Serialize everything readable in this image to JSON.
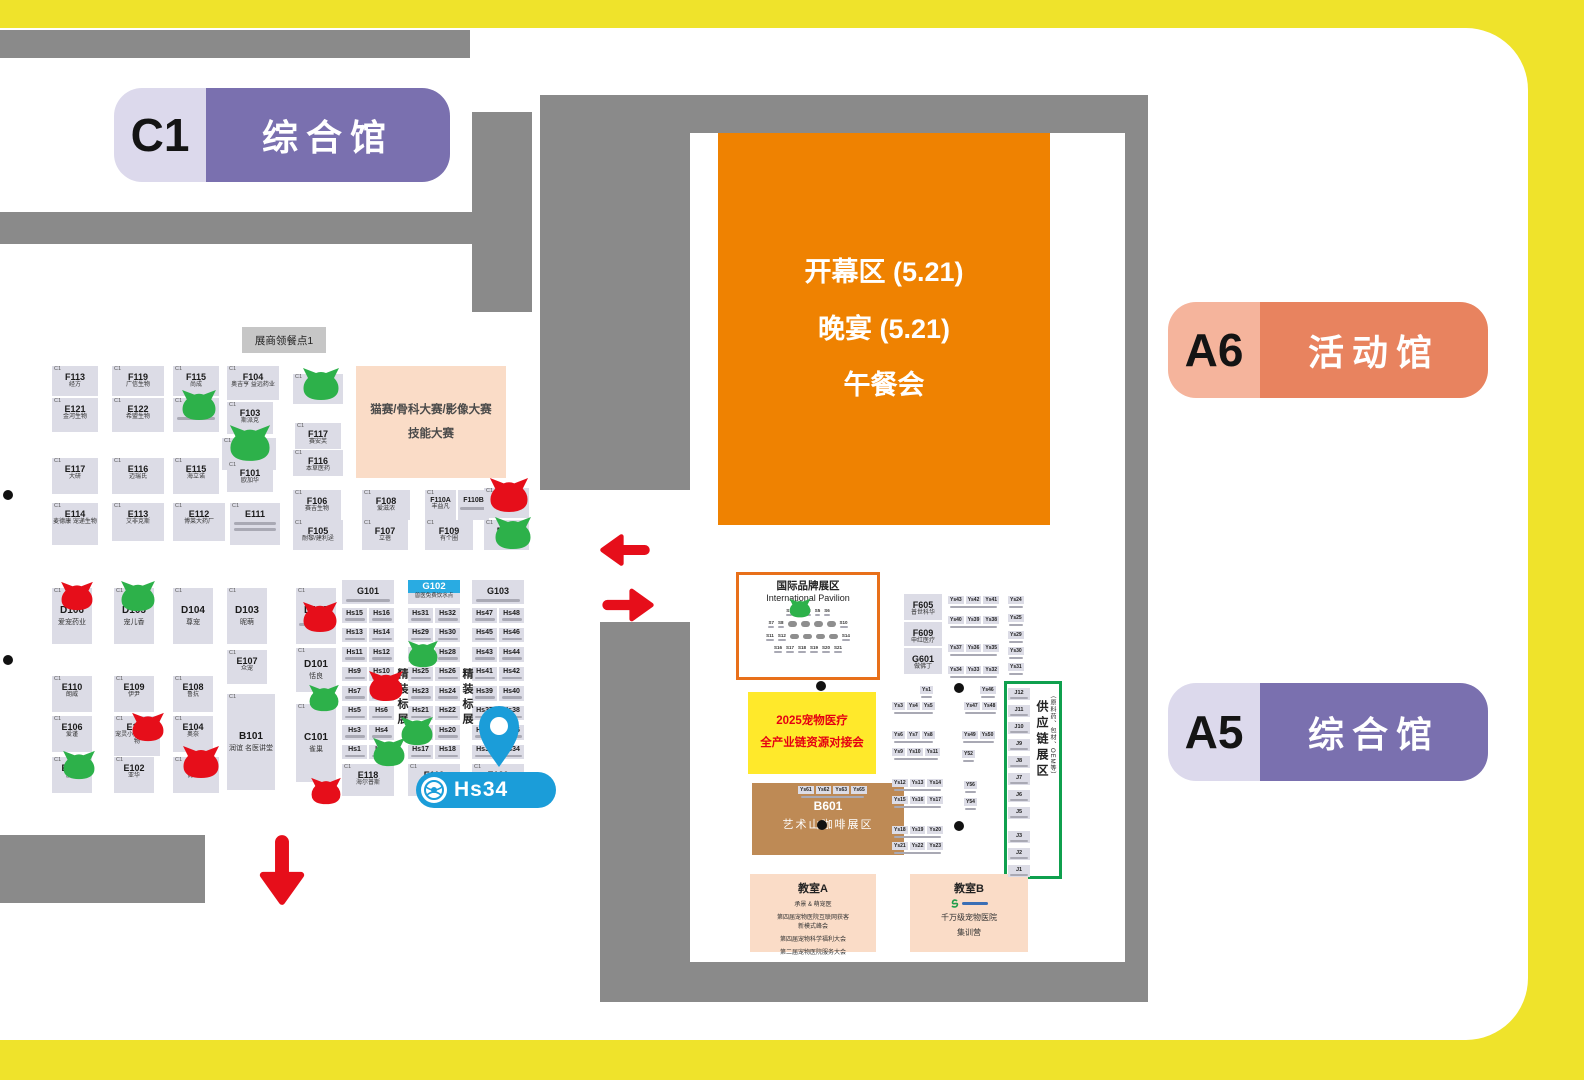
{
  "colors": {
    "frame_yellow": "#EFE32B",
    "wall_gray": "#8A8A8A",
    "booth_bg": "#DCDCE6",
    "purple": "#7A70AF",
    "purple_light": "#DCD9EC",
    "orange_deep": "#EF8201",
    "orange_pill": "#E8835F",
    "orange_pill_light": "#F5B49C",
    "pink_box": "#FADCC7",
    "yellow_box": "#FFE92B",
    "brown": "#BE8A55",
    "red": "#E60E1A",
    "green": "#2DB14A",
    "blue": "#29ABE2",
    "pin_blue": "#1B9DD9",
    "supply_green": "#0FA04E",
    "pavilion_border": "#E8701A",
    "text_red": "#E50012"
  },
  "halls": {
    "c1": {
      "code": "C1",
      "label": "综合馆"
    },
    "a6": {
      "code": "A6",
      "label": "活动馆"
    },
    "a5": {
      "code": "A5",
      "label": "综合馆"
    }
  },
  "marker": {
    "label": "Hs34"
  },
  "left_map": {
    "meal_label": "展商领餐点1",
    "contest": {
      "l1": "猫赛/骨科大赛/影像大赛",
      "l2": "技能大赛"
    },
    "booths": [
      {
        "x": 52,
        "y": 366,
        "w": 46,
        "h": 30,
        "hall": "C1",
        "code": "F113",
        "name": "经方"
      },
      {
        "x": 112,
        "y": 366,
        "w": 52,
        "h": 30,
        "hall": "C1",
        "code": "F119",
        "name": "广信生物"
      },
      {
        "x": 173,
        "y": 366,
        "w": 46,
        "h": 30,
        "hall": "C1",
        "code": "F115",
        "name": "尚成"
      },
      {
        "x": 227,
        "y": 366,
        "w": 52,
        "h": 34,
        "hall": "C1",
        "code": "F104",
        "name": "奥吉亨 益远药业"
      },
      {
        "x": 293,
        "y": 374,
        "w": 50,
        "h": 30,
        "hall": "C1",
        "code": "F118",
        "name": "小可爱药"
      },
      {
        "x": 52,
        "y": 398,
        "w": 46,
        "h": 34,
        "hall": "C1",
        "code": "E121",
        "name": "金河生物"
      },
      {
        "x": 112,
        "y": 398,
        "w": 52,
        "h": 34,
        "hall": "C1",
        "code": "E122",
        "name": "希盟生物"
      },
      {
        "x": 173,
        "y": 398,
        "w": 46,
        "h": 34,
        "hall": "C1",
        "code": "E123",
        "sm": 1
      },
      {
        "x": 227,
        "y": 402,
        "w": 46,
        "h": 32,
        "hall": "C1",
        "code": "F103",
        "name": "斯派克"
      },
      {
        "x": 295,
        "y": 423,
        "w": 46,
        "h": 26,
        "hall": "C1",
        "code": "F117",
        "name": "赛安芙"
      },
      {
        "x": 293,
        "y": 450,
        "w": 50,
        "h": 26,
        "hall": "C1",
        "code": "F116",
        "name": "本草医药"
      },
      {
        "x": 222,
        "y": 438,
        "w": 54,
        "h": 32,
        "hall": "C1",
        "code": "F102",
        "name": "宜景康"
      },
      {
        "x": 52,
        "y": 458,
        "w": 46,
        "h": 36,
        "hall": "C1",
        "code": "E117",
        "name": "大研"
      },
      {
        "x": 112,
        "y": 458,
        "w": 52,
        "h": 36,
        "hall": "C1",
        "code": "E116",
        "name": "迈瑞氏"
      },
      {
        "x": 173,
        "y": 458,
        "w": 46,
        "h": 36,
        "hall": "C1",
        "code": "E115",
        "name": "海立诺"
      },
      {
        "x": 227,
        "y": 462,
        "w": 46,
        "h": 30,
        "hall": "C1",
        "code": "F101",
        "name": "欧加华"
      },
      {
        "x": 52,
        "y": 503,
        "w": 46,
        "h": 42,
        "hall": "C1",
        "code": "E114",
        "name": "麦德康 宠递生物"
      },
      {
        "x": 112,
        "y": 503,
        "w": 52,
        "h": 38,
        "hall": "C1",
        "code": "E113",
        "name": "艾非克斯"
      },
      {
        "x": 173,
        "y": 503,
        "w": 52,
        "h": 38,
        "hall": "C1",
        "code": "E112",
        "name": "博莱大药厂"
      },
      {
        "x": 230,
        "y": 503,
        "w": 50,
        "h": 42,
        "hall": "C1",
        "code": "E111",
        "sm": 2
      },
      {
        "x": 293,
        "y": 490,
        "w": 48,
        "h": 30,
        "hall": "C1",
        "code": "F106",
        "name": "赛吉生物"
      },
      {
        "x": 293,
        "y": 520,
        "w": 50,
        "h": 30,
        "hall": "C1",
        "code": "F105",
        "name": "耐黎/建利迳"
      },
      {
        "x": 362,
        "y": 490,
        "w": 48,
        "h": 30,
        "hall": "C1",
        "code": "F108",
        "name": "爱滋浓"
      },
      {
        "x": 362,
        "y": 520,
        "w": 46,
        "h": 30,
        "hall": "C1",
        "code": "F107",
        "name": "立蓓"
      },
      {
        "x": 425,
        "y": 490,
        "w": 31,
        "h": 30,
        "hall": "C1",
        "code": "F110A",
        "name": "丰益凡",
        "fs": 7
      },
      {
        "x": 458,
        "y": 490,
        "w": 31,
        "h": 30,
        "code": "F110B",
        "sm": 1,
        "fs": 7
      },
      {
        "x": 425,
        "y": 520,
        "w": 48,
        "h": 30,
        "hall": "C1",
        "code": "F109",
        "name": "有个圈"
      },
      {
        "x": 484,
        "y": 488,
        "w": 45,
        "h": 30,
        "hall": "C1",
        "code": "F112",
        "name": "安里弗斯"
      },
      {
        "x": 484,
        "y": 520,
        "w": 45,
        "h": 30,
        "hall": "C1",
        "code": "F111",
        "name": "汇宠"
      },
      {
        "x": 52,
        "y": 588,
        "w": 40,
        "h": 56,
        "hall": "C1",
        "code": "D106",
        "name": "爱宠药业",
        "big": true
      },
      {
        "x": 114,
        "y": 588,
        "w": 40,
        "h": 56,
        "hall": "C1",
        "code": "D105",
        "name": "宠儿香",
        "big": true
      },
      {
        "x": 173,
        "y": 588,
        "w": 40,
        "h": 56,
        "hall": "C1",
        "code": "D104",
        "name": "尊宠",
        "big": true
      },
      {
        "x": 227,
        "y": 588,
        "w": 40,
        "h": 56,
        "hall": "C1",
        "code": "D103",
        "name": "昵萌",
        "big": true
      },
      {
        "x": 296,
        "y": 588,
        "w": 40,
        "h": 56,
        "hall": "C1",
        "code": "D102",
        "sm": 1,
        "big": true
      },
      {
        "x": 227,
        "y": 650,
        "w": 40,
        "h": 34,
        "hall": "C1",
        "code": "E107",
        "name": "众宠"
      },
      {
        "x": 296,
        "y": 648,
        "w": 40,
        "h": 44,
        "hall": "C1",
        "code": "D101",
        "name": "恬良",
        "big": true
      },
      {
        "x": 52,
        "y": 676,
        "w": 40,
        "h": 36,
        "hall": "C1",
        "code": "E110",
        "name": "朗威"
      },
      {
        "x": 114,
        "y": 676,
        "w": 40,
        "h": 36,
        "hall": "C1",
        "code": "E109",
        "name": "伊尹"
      },
      {
        "x": 173,
        "y": 676,
        "w": 40,
        "h": 36,
        "hall": "C1",
        "code": "E108",
        "name": "鲁抗"
      },
      {
        "x": 52,
        "y": 716,
        "w": 40,
        "h": 36,
        "hall": "C1",
        "code": "E106",
        "name": "爱谨"
      },
      {
        "x": 114,
        "y": 716,
        "w": 46,
        "h": 40,
        "hall": "C1",
        "code": "E105",
        "name": "宠灵小凤 维宠生物"
      },
      {
        "x": 173,
        "y": 716,
        "w": 40,
        "h": 36,
        "hall": "C1",
        "code": "E104",
        "name": "奥奈"
      },
      {
        "x": 227,
        "y": 694,
        "w": 48,
        "h": 96,
        "hall": "C1",
        "code": "B101",
        "name": "润谊 名医讲堂",
        "big": true
      },
      {
        "x": 296,
        "y": 704,
        "w": 40,
        "h": 78,
        "hall": "C1",
        "code": "C101",
        "name": "雀巢",
        "big": true
      },
      {
        "x": 52,
        "y": 757,
        "w": 40,
        "h": 36,
        "hall": "C1",
        "code": "E103",
        "name": "胶进"
      },
      {
        "x": 114,
        "y": 757,
        "w": 40,
        "h": 36,
        "hall": "C1",
        "code": "E102",
        "name": "亚华"
      },
      {
        "x": 173,
        "y": 757,
        "w": 46,
        "h": 36,
        "hall": "C1",
        "code": "E101",
        "name": "优利特"
      },
      {
        "x": 342,
        "y": 764,
        "w": 52,
        "h": 32,
        "hall": "C1",
        "code": "E118",
        "name": "海尔普斯"
      },
      {
        "x": 408,
        "y": 764,
        "w": 52,
        "h": 32,
        "hall": "C1",
        "code": "E119"
      },
      {
        "x": 472,
        "y": 764,
        "w": 52,
        "h": 32,
        "hall": "C1",
        "code": "E120",
        "sm": 1
      }
    ],
    "g_row": [
      {
        "x": 342,
        "y": 580,
        "w": 52,
        "h": 24,
        "code": "G101",
        "sm": 1
      },
      {
        "x": 408,
        "y": 580,
        "w": 52,
        "h": 24,
        "code": "G102",
        "name": "兽医免费饮水点",
        "blue": true
      },
      {
        "x": 472,
        "y": 580,
        "w": 52,
        "h": 24,
        "code": "G103",
        "sm": 1
      }
    ],
    "hs_columns": [
      {
        "x": 342,
        "rows": [
          [
            "Hs15",
            "Hs16"
          ],
          [
            "Hs13",
            "Hs14"
          ],
          [
            "Hs11",
            "Hs12"
          ],
          [
            "Hs9",
            "Hs10"
          ],
          [
            "Hs7",
            "Hs8"
          ],
          [
            "Hs5",
            "Hs6"
          ],
          [
            "Hs3",
            "Hs4"
          ],
          [
            "Hs1",
            "Hs2"
          ]
        ]
      },
      {
        "x": 408,
        "rows": [
          [
            "Hs31",
            "Hs32"
          ],
          [
            "Hs29",
            "Hs30"
          ],
          [
            "Hs27",
            "Hs28"
          ],
          [
            "Hs25",
            "Hs26"
          ],
          [
            "Hs23",
            "Hs24"
          ],
          [
            "Hs21",
            "Hs22"
          ],
          [
            "Hs19",
            "Hs20"
          ],
          [
            "Hs17",
            "Hs18"
          ]
        ]
      },
      {
        "x": 472,
        "rows": [
          [
            "Hs47",
            "Hs48"
          ],
          [
            "Hs45",
            "Hs46"
          ],
          [
            "Hs43",
            "Hs44"
          ],
          [
            "Hs41",
            "Hs42"
          ],
          [
            "Hs39",
            "Hs40"
          ],
          [
            "Hs37",
            "Hs38"
          ],
          [
            "Hs35",
            "Hs36"
          ],
          [
            "Hs33",
            "Hs34"
          ]
        ]
      }
    ],
    "vertical_labels": [
      {
        "x": 394,
        "y": 668,
        "t": "精装标展"
      },
      {
        "x": 459,
        "y": 668,
        "t": "精装标展"
      }
    ]
  },
  "right_map": {
    "opening": {
      "l1": "开幕区 (5.21)",
      "l2": "晚宴 (5.21)",
      "l3": "午餐会"
    },
    "pavilion": {
      "title": "国际品牌展区",
      "subtitle": "International Pavilion",
      "rows": [
        [
          "S1",
          "S2",
          "S3",
          "S5",
          "S6"
        ],
        [
          "S7",
          "S8",
          "~",
          "~",
          "~",
          "~",
          "S10"
        ],
        [
          "S11",
          "S12",
          "~",
          "~",
          "~",
          "~",
          "S14"
        ],
        [
          "S16",
          "S17",
          "S18",
          "S19",
          "S20",
          "S21"
        ]
      ]
    },
    "match_box": {
      "l1": "2025宠物医疗",
      "l2": "全产业链资源对接会"
    },
    "b601": {
      "code": "B601",
      "name": "艺术山咖啡展区"
    },
    "ys61_row": {
      "x": 798,
      "y": 786,
      "codes": [
        "Ys61",
        "Ys62",
        "Ys63",
        "Ys65"
      ]
    },
    "f_col": [
      {
        "x": 904,
        "y": 594,
        "w": 38,
        "h": 26,
        "code": "F605",
        "name": "普世科华"
      },
      {
        "x": 904,
        "y": 622,
        "w": 38,
        "h": 24,
        "code": "F609",
        "name": "申红医疗"
      },
      {
        "x": 904,
        "y": 648,
        "w": 38,
        "h": 26,
        "code": "G601",
        "name": "做佛丁"
      }
    ],
    "ys_groups": [
      {
        "x": 948,
        "y": 596,
        "codes": [
          "Ys43",
          "Ys42",
          "Ys41"
        ]
      },
      {
        "x": 948,
        "y": 616,
        "codes": [
          "Ys40",
          "Ys39",
          "Ys38"
        ]
      },
      {
        "x": 948,
        "y": 644,
        "codes": [
          "Ys37",
          "Ys36",
          "Ys35"
        ]
      },
      {
        "x": 948,
        "y": 666,
        "codes": [
          "Ys34",
          "Ys33",
          "Ys32"
        ]
      },
      {
        "x": 1008,
        "y": 596,
        "codes": [
          "Ys24"
        ]
      },
      {
        "x": 1008,
        "y": 614,
        "codes": [
          "Ys25"
        ]
      },
      {
        "x": 1008,
        "y": 631,
        "codes": [
          "Ys29"
        ]
      },
      {
        "x": 1008,
        "y": 647,
        "codes": [
          "Ys30"
        ]
      },
      {
        "x": 1008,
        "y": 663,
        "codes": [
          "Ys31"
        ]
      },
      {
        "x": 920,
        "y": 686,
        "codes": [
          "Ys1"
        ]
      },
      {
        "x": 980,
        "y": 686,
        "codes": [
          "Ys46"
        ]
      },
      {
        "x": 892,
        "y": 702,
        "codes": [
          "Ys3",
          "Ys4",
          "Ys5"
        ]
      },
      {
        "x": 964,
        "y": 702,
        "codes": [
          "Ys47",
          "Ys48"
        ]
      },
      {
        "x": 892,
        "y": 731,
        "codes": [
          "Ys6",
          "Ys7",
          "Ys8"
        ]
      },
      {
        "x": 962,
        "y": 731,
        "codes": [
          "Ys49",
          "Ys50"
        ]
      },
      {
        "x": 892,
        "y": 748,
        "codes": [
          "Ys9",
          "Ys10",
          "Ys11"
        ]
      },
      {
        "x": 962,
        "y": 750,
        "codes": [
          "Y52"
        ]
      },
      {
        "x": 892,
        "y": 779,
        "codes": [
          "Ys12",
          "Ys13",
          "Ys14"
        ]
      },
      {
        "x": 964,
        "y": 781,
        "codes": [
          "Y56"
        ]
      },
      {
        "x": 892,
        "y": 796,
        "codes": [
          "Ys15",
          "Ys16",
          "Ys17"
        ]
      },
      {
        "x": 964,
        "y": 798,
        "codes": [
          "Y54"
        ]
      },
      {
        "x": 892,
        "y": 826,
        "codes": [
          "Ys18",
          "Ys19",
          "Ys20"
        ]
      },
      {
        "x": 892,
        "y": 842,
        "codes": [
          "Ys21",
          "Ys22",
          "Ys23"
        ]
      }
    ],
    "supply": {
      "title": "供应链展区",
      "subtitle": "（原料药、包材、OEM等）",
      "j_codes": [
        "J12",
        "J11",
        "J10",
        "J9",
        "J8",
        "J7",
        "J6",
        "J5",
        "J3",
        "J2",
        "J1"
      ]
    },
    "classroom_a": {
      "title": "教室A",
      "lines": [
        "承景 & 萌宠医",
        "第四届宠物医院互联网获客",
        "新模式峰会",
        "第四届宠物科学福利大会",
        "第二届宠物医院服务大会"
      ]
    },
    "classroom_b": {
      "title": "教室B",
      "lines": [
        "千万级宠物医院",
        "集训营"
      ]
    }
  },
  "cats": [
    {
      "x": 179,
      "y": 389,
      "w": 40,
      "h": 32,
      "c": "green"
    },
    {
      "x": 300,
      "y": 367,
      "w": 42,
      "h": 34,
      "c": "green"
    },
    {
      "x": 226,
      "y": 424,
      "w": 48,
      "h": 38,
      "c": "green"
    },
    {
      "x": 487,
      "y": 477,
      "w": 44,
      "h": 36,
      "c": "red"
    },
    {
      "x": 492,
      "y": 516,
      "w": 42,
      "h": 34,
      "c": "green"
    },
    {
      "x": 58,
      "y": 581,
      "w": 38,
      "h": 30,
      "c": "red"
    },
    {
      "x": 118,
      "y": 580,
      "w": 40,
      "h": 32,
      "c": "green"
    },
    {
      "x": 300,
      "y": 601,
      "w": 40,
      "h": 32,
      "c": "red"
    },
    {
      "x": 306,
      "y": 684,
      "w": 36,
      "h": 28,
      "c": "green"
    },
    {
      "x": 130,
      "y": 712,
      "w": 36,
      "h": 30,
      "c": "red"
    },
    {
      "x": 180,
      "y": 745,
      "w": 42,
      "h": 34,
      "c": "red"
    },
    {
      "x": 60,
      "y": 750,
      "w": 38,
      "h": 30,
      "c": "green"
    },
    {
      "x": 308,
      "y": 777,
      "w": 36,
      "h": 28,
      "c": "red"
    },
    {
      "x": 405,
      "y": 640,
      "w": 36,
      "h": 28,
      "c": "green"
    },
    {
      "x": 366,
      "y": 670,
      "w": 40,
      "h": 32,
      "c": "red"
    },
    {
      "x": 398,
      "y": 716,
      "w": 38,
      "h": 30,
      "c": "green"
    },
    {
      "x": 370,
      "y": 737,
      "w": 38,
      "h": 30,
      "c": "green"
    },
    {
      "x": 787,
      "y": 598,
      "w": 26,
      "h": 20,
      "c": "green"
    }
  ],
  "dots": [
    {
      "x": 3,
      "y": 490
    },
    {
      "x": 3,
      "y": 655
    },
    {
      "x": 816,
      "y": 681
    },
    {
      "x": 954,
      "y": 683
    },
    {
      "x": 817,
      "y": 820
    },
    {
      "x": 954,
      "y": 821
    }
  ],
  "arrows": [
    {
      "x": 598,
      "y": 528,
      "w": 54,
      "h": 44,
      "dir": "left"
    },
    {
      "x": 600,
      "y": 583,
      "w": 56,
      "h": 44,
      "dir": "right"
    },
    {
      "x": 254,
      "y": 832,
      "w": 56,
      "h": 76,
      "dir": "down"
    }
  ]
}
